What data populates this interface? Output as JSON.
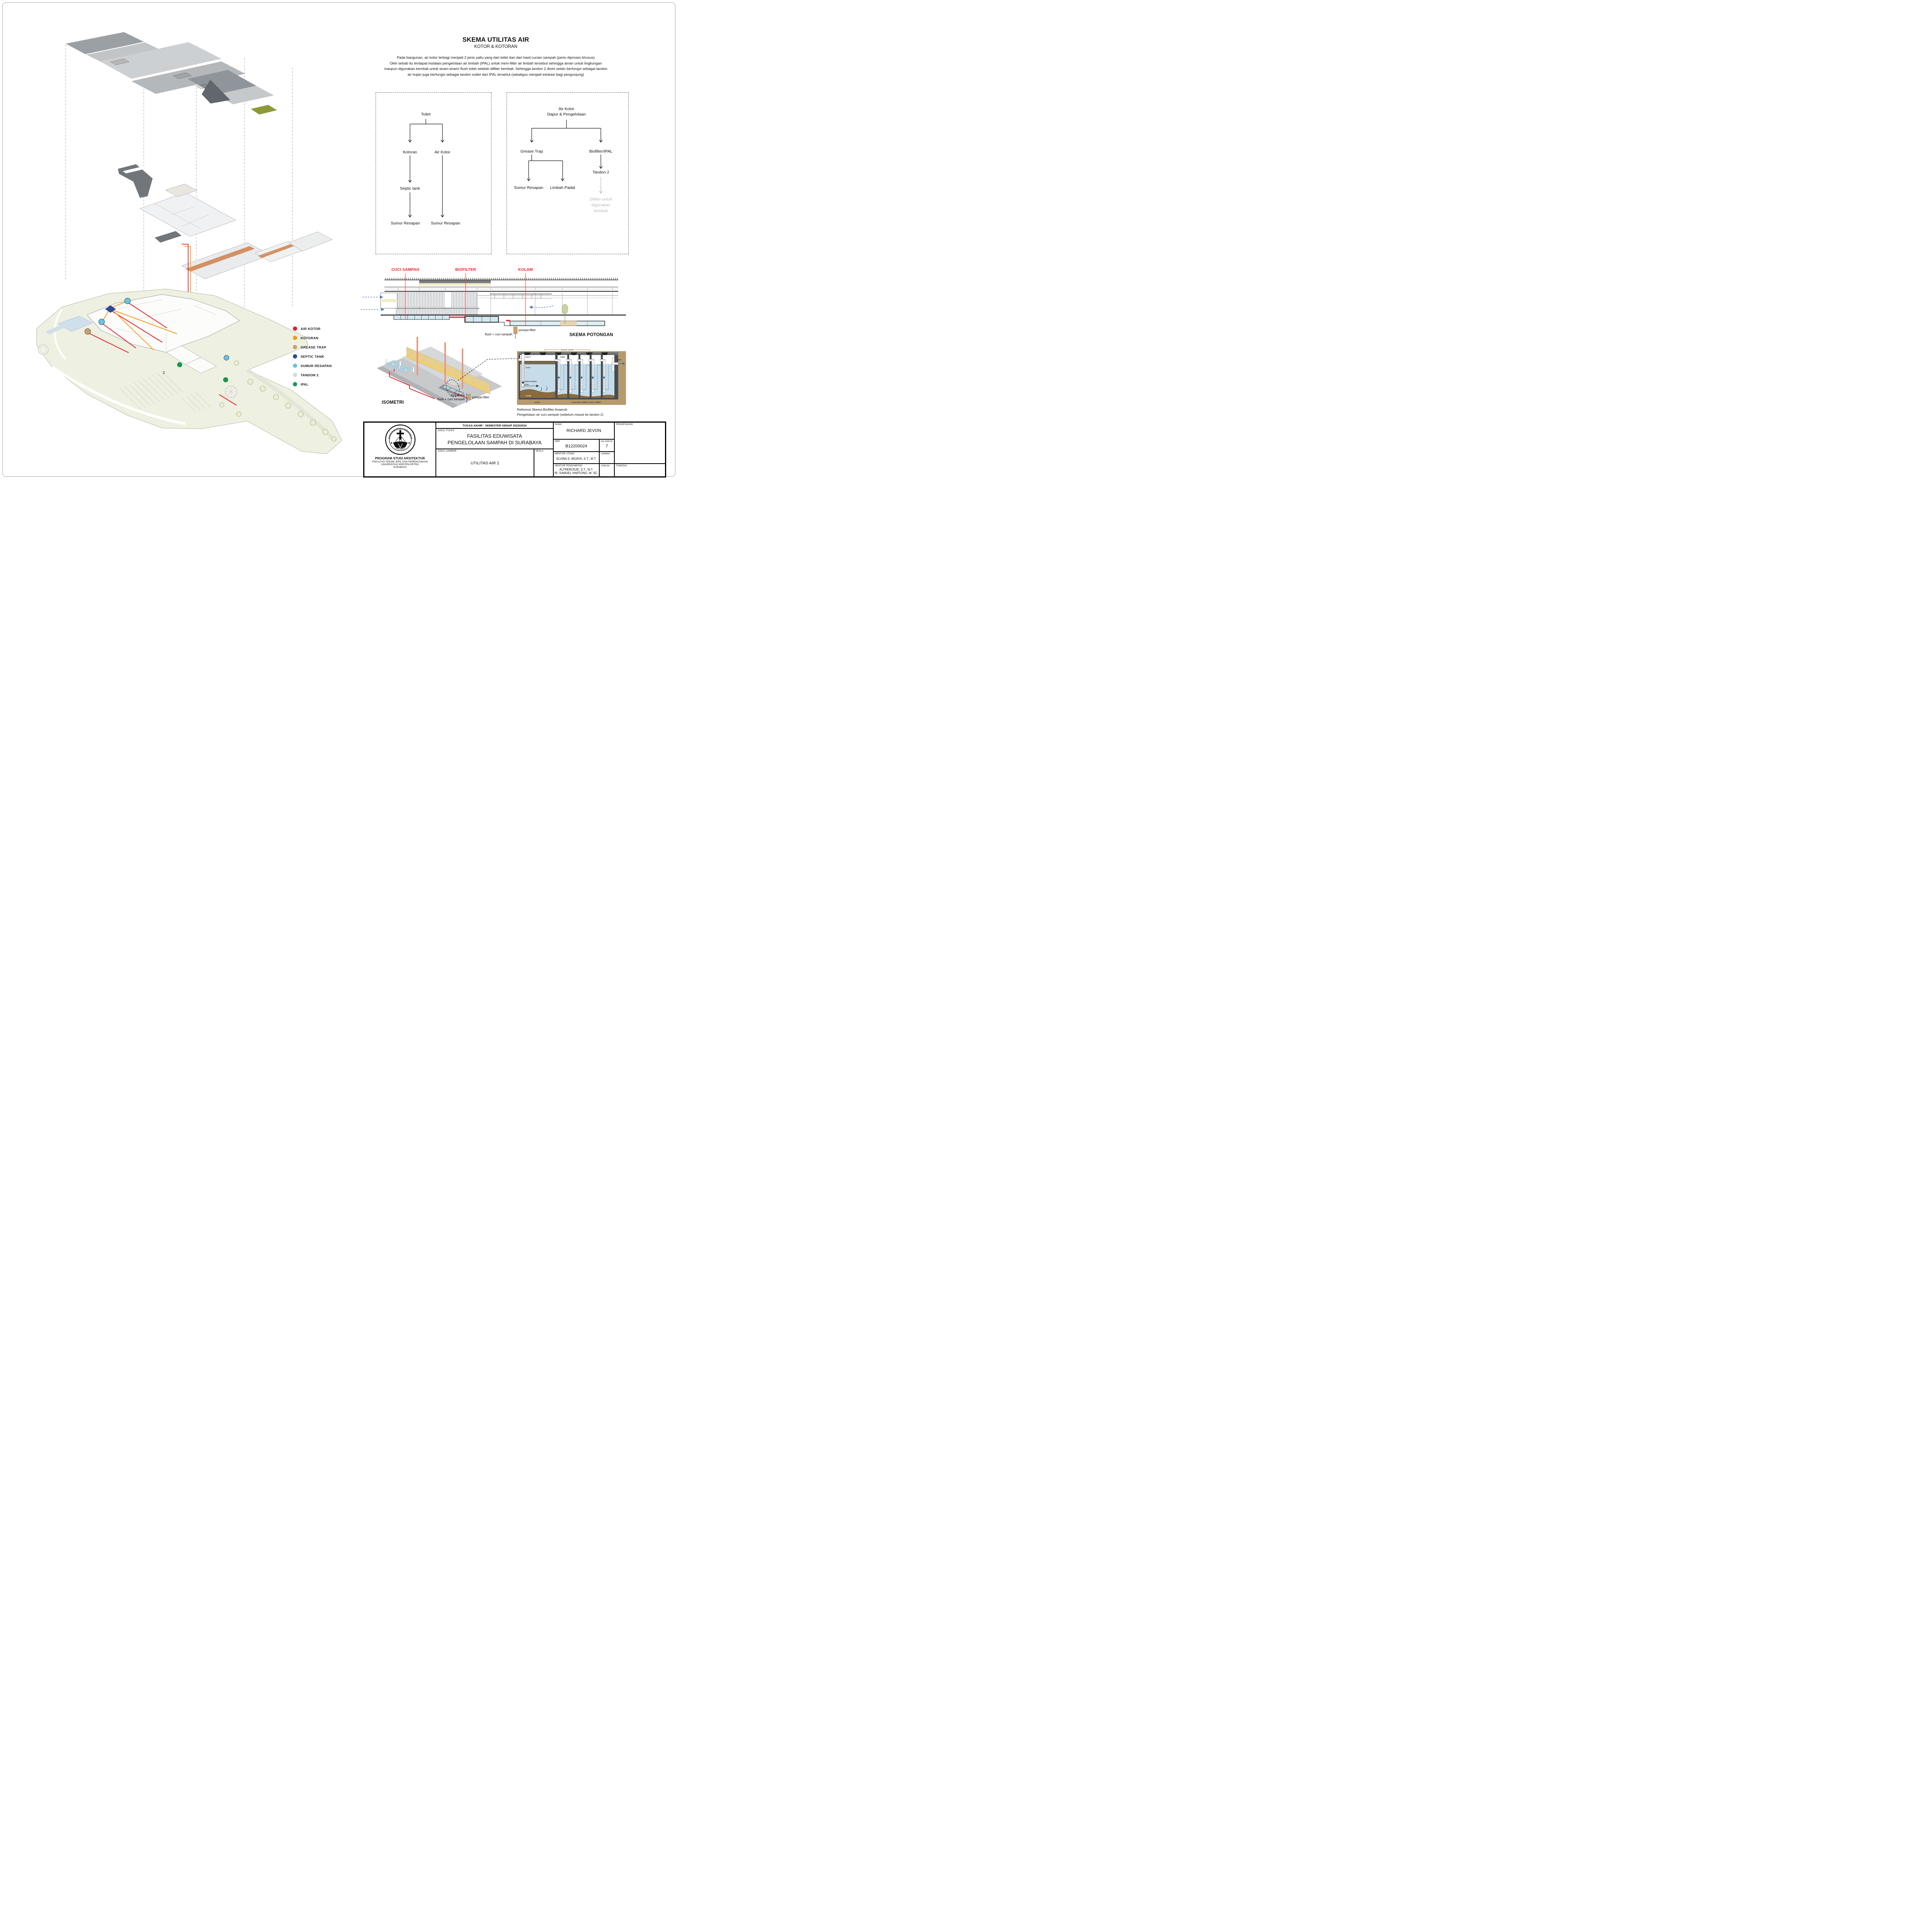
{
  "sheet": {
    "heading": {
      "title": "SKEMA UTILITAS AIR",
      "subtitle": "KOTOR & KOTORAN"
    },
    "paragraph": {
      "line1": "Pada bangunan, air kotor terbagi menjadi 2 jenis yaitu yang dari toilet dan dari hasil cucian sampah (perlu diproses khusus)",
      "line2": "Oleh sebab itu terdapat instalasi pengelolaan air limbah (IPAL) untuk mem-filter air limbah tersebut sehingga aman untuk lingkungan",
      "line3": "maupun digunakan kembali untuk siram-siram/ flush toilet setelah difilter kembali. Sehingga tandon 2 disini selain berfungsi sebagai tandon",
      "line4": "air hujan juga berfungsi sebagai tandon outlet dari IPAL tersebut (sekaligus menjadi edukasi bagi pengunjung)"
    }
  },
  "flow_toilet": {
    "root": "Toilet",
    "kotoran": "Kotoran",
    "air_kotor": "Air Kotor",
    "septic": "Septic tank",
    "sumur1": "Sumur Resapan",
    "sumur2": "Sumur Resapan"
  },
  "flow_dapur": {
    "root_line1": "Air Kotor",
    "root_line2": "Dapur & Pengelolaan",
    "grease": "Grease Trap",
    "biofilter": "Biofilter/IPAL",
    "sumur": "Sumur Resapan",
    "limbah": "Limbah Padat",
    "tandon": "Tandon 2",
    "difilter_line1": "Difilter untuk",
    "difilter_line2": "digunakan",
    "difilter_line3": "kembali"
  },
  "legend": {
    "items": [
      {
        "label": "AIR KOTOR",
        "color": "#e1232d"
      },
      {
        "label": "KOTORAN",
        "color": "#f49b20"
      },
      {
        "label": "GREASE TRAP",
        "color": "#c8a06c"
      },
      {
        "label": "SEPTIC TANK",
        "color": "#2a4b9b"
      },
      {
        "label": "SUMUR RESAPAN",
        "color": "#66c5e3"
      },
      {
        "label": "TANDON 2",
        "color": "#cfdde0"
      },
      {
        "label": "IPAL",
        "color": "#169b4d"
      }
    ]
  },
  "section_scheme": {
    "label_cuci": "CUCI SAMPAH",
    "label_biofilter": "BIOFILTER",
    "label_kolam": "KOLAM",
    "title": "SKEMA POTONGAN",
    "flush": "flush + cuci sampah",
    "pompa": "pompa+filter",
    "label_color": "#ed1c24"
  },
  "isometri": {
    "title": "ISOMETRI",
    "note_line1": "bisa untuk",
    "note_line2": "flush + cuci sampah",
    "pompa": "pompa+filter"
  },
  "biofilter_diagram": {
    "access": "access covers",
    "inlet": "inlet-T",
    "baffle": "baffle",
    "scum": "scum",
    "sed_line1": "sedimentation",
    "sed_line2": "zone",
    "sludge": "sludge",
    "settler": "settler",
    "abr": "anaerobic baffled reactor (ABR)",
    "outlet": "outlet",
    "caption_line1": "Referensi Skema Biofilter Anaerob",
    "caption_line2": "Pengelolaan air cuci sampah (sebelum masuk ke tandon 2)"
  },
  "site_plan": {
    "tandon_mark": "2"
  },
  "titleblock": {
    "header": "TUGAS AKHIR - SEMESTER GENAP 2023/2024",
    "judul_tugas_label": "JUDUL TUGAS",
    "judul_tugas_1": "FASILITAS EDUWISATA",
    "judul_tugas_2": "PENGELOLAAN SAMPAH DI SURABAYA",
    "judul_gambar_label": "JUDUL GAMBAR",
    "judul_gambar": "UTILITAS AIR 2",
    "skala_label": "SKALA",
    "nama_label": "NAMA",
    "nama": "RICHARD JEVON",
    "nrp_label": "NRP",
    "nrp": "B12200024",
    "kelompok_label": "KELOMPOK",
    "kelompok": "7",
    "mentor_utama_label": "MENTOR UTAMA",
    "mentor_utama": "ELVINA S. WIJAYA, S.T., M.T.",
    "mentor_pendamping_label": "MENTOR PENDAMPING",
    "mentor_pendamping_1": "ALTREROSJE, S.T., M.T.",
    "mentor_pendamping_2": "IR. SAMUEL HARTONO, M. SC.",
    "lembar_label": "LEMBAR",
    "jumlah_label": "JUMLAH",
    "tanggal_label": "TANGGAL",
    "pengesahan_label": "PENGESAHAN",
    "institution": [
      "PROGRAM STUDI ARSITEKTUR",
      "FAKULTAS TEKNIK SIPIL DAN PERENCANAAN",
      "UNIVERSITAS KRISTEN PETRA",
      "SURABAYA"
    ],
    "logo_top": "UNIVERSITAS KRISTEN",
    "logo_bottom": "PETRA"
  }
}
